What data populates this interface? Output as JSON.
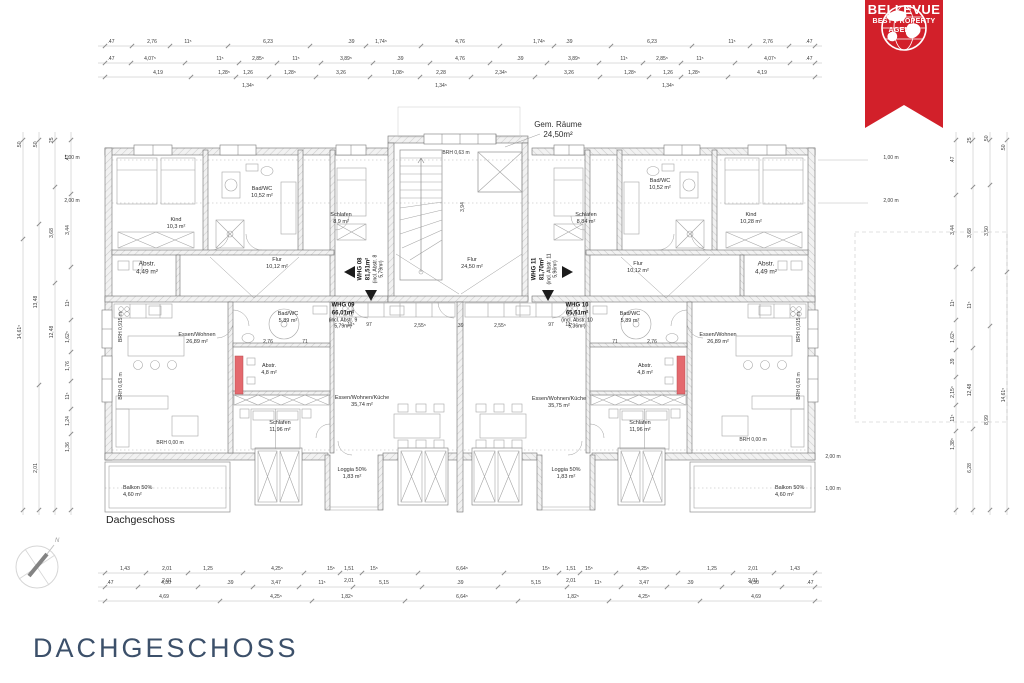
{
  "page_title": "DACHGESCHOSS",
  "plan_caption": "Dachgeschoss",
  "badge": {
    "brand": "BELLEVUE",
    "tagline_line1": "BEST PROPERTY",
    "tagline_line2": "AGENTS",
    "ribbon_color": "#d2202a"
  },
  "compass": {
    "north": "N"
  },
  "apartments": {
    "whg08": {
      "l1": "WHG 08",
      "l2": "81,51m²",
      "l3": "(incl. Abstr. 8",
      "l4": "5,79m²)"
    },
    "whg09": {
      "l1": "WHG 09",
      "l2": "66,01m²",
      "l3": "(incl. Abstr. 9",
      "l4": "5,79m²)"
    },
    "whg10": {
      "l1": "WHG 10",
      "l2": "65,61m²",
      "l3": "(incl. Abstr. 10",
      "l4": "5,36m²)"
    },
    "whg11": {
      "l1": "WHG 11",
      "l2": "81,70m²",
      "l3": "(incl. Abstr. 11",
      "l4": "5,96m²)"
    }
  },
  "rooms": {
    "gem": {
      "l1": "Gem. Räume",
      "l2": "24,50m²"
    },
    "flur_c": {
      "l1": "Flur",
      "l2": "24,50 m²"
    },
    "kind_l": {
      "l1": "Kind",
      "l2": "10,3 m²"
    },
    "bad_tl": {
      "l1": "Bad/WC",
      "l2": "10,52 m²"
    },
    "schlafen_tl": {
      "l1": "Schlafen",
      "l2": "8,9 m²"
    },
    "abstr_tl": {
      "l1": "Abstr.",
      "l2": "4,49 m²"
    },
    "flur_tl": {
      "l1": "Flur",
      "l2": "10,12 m²"
    },
    "kind_r": {
      "l1": "Kind",
      "l2": "10,28 m²"
    },
    "bad_tr": {
      "l1": "Bad/WC",
      "l2": "10,52 m²"
    },
    "schlafen_tr": {
      "l1": "Schlafen",
      "l2": "8,84 m²"
    },
    "abstr_tr": {
      "l1": "Abstr.",
      "l2": "4,49 m²"
    },
    "flur_tr": {
      "l1": "Flur",
      "l2": "10,12 m²"
    },
    "essen_l": {
      "l1": "Essen/Wohnen",
      "l2": "26,89 m²"
    },
    "badwc_9": {
      "l1": "Bad/WC",
      "l2": "5,89 m²"
    },
    "abstr_9": {
      "l1": "Abstr.",
      "l2": "4,8 m²"
    },
    "ewk_9": {
      "l1": "Essen/Wohnen/Küche",
      "l2": "35,74 m²"
    },
    "schlafen_9": {
      "l1": "Schlafen",
      "l2": "11,96 m²"
    },
    "loggia_9": {
      "l1": "Loggia 50%",
      "l2": "1,83 m²"
    },
    "balkon_l": {
      "l1": "Balkon 50%",
      "l2": "4,60 m²"
    },
    "essen_r": {
      "l1": "Essen/Wohnen",
      "l2": "26,89 m²"
    },
    "badwc_10": {
      "l1": "Bad/WC",
      "l2": "5,89 m²"
    },
    "abstr_10": {
      "l1": "Abstr.",
      "l2": "4,8 m²"
    },
    "ewk_10": {
      "l1": "Essen/Wohnen/Küche",
      "l2": "35,75 m²"
    },
    "schlafen_10": {
      "l1": "Schlafen",
      "l2": "11,96 m²"
    },
    "loggia_10": {
      "l1": "Loggia 50%",
      "l2": "1,83 m²"
    },
    "balkon_r": {
      "l1": "Balkon 50%",
      "l2": "4,60 m²"
    }
  },
  "annotations": {
    "brh_stair": "BRH 0,63 m",
    "dim394": "3,94",
    "brh000": "BRH 0,00 m",
    "brh0915": "BRH 0,915 m",
    "brh063": "BRH 0,63 m",
    "h100": "1,00 m",
    "h200": "2,00 m"
  },
  "dims": {
    "top1": [
      ".47",
      "2,76",
      "11⁵",
      "6,23",
      ".39",
      "1,74⁵",
      "4,76",
      "1,74⁵",
      ".39",
      "6,23",
      "11⁵",
      "2,76",
      ".47"
    ],
    "top2": [
      ".47",
      "4,07⁵",
      "11⁵",
      "2,85⁵",
      "11⁵",
      "3,89⁵",
      ".39",
      "4,76",
      ".39",
      "3,89⁵",
      "11⁵",
      "2,85⁵",
      "11⁵",
      "4,07⁵",
      ".47"
    ],
    "top3": [
      "4,19",
      "1,28⁵",
      "1,26",
      "1,28⁵",
      "3,26",
      "1,08⁵",
      "2,28",
      "2,34⁵",
      "3,26",
      "1,28⁵",
      "1,26",
      "1,28⁵",
      "4,19"
    ],
    "top3_sub": [
      "1,34⁵",
      "1,34⁵",
      "1,34⁵"
    ],
    "bottom1": [
      "1,43",
      "2,01",
      "1,25",
      "4,25⁵",
      "15⁵",
      "1,51",
      "15⁵",
      "6,64⁵",
      "15⁵",
      "1,51",
      "15⁵",
      "4,25⁵",
      "1,25",
      "2,01",
      "1,43"
    ],
    "bottom1_sub": [
      "2,01",
      "2,01",
      "2,01",
      "2,01"
    ],
    "bottom2": [
      ".47",
      "4,30",
      ".39",
      "3,47",
      "11⁵",
      "5,15",
      ".39",
      "5,15",
      "11⁵",
      "3,47",
      ".39",
      "4,30",
      ".47"
    ],
    "bottom3": [
      "4,69",
      "4,25⁵",
      "1,82⁵",
      "6,64⁵",
      "1,82⁵",
      "4,25⁵",
      "4,69"
    ],
    "left": [
      ".50",
      "14,61⁵",
      ".50",
      "13,48",
      "2,01",
      ".25",
      "3,68",
      "12,48",
      ".47",
      "3,44",
      "11⁵",
      "1,62⁵",
      "1,76",
      "11⁵",
      "1,24",
      "1,36"
    ],
    "right": [
      ".47",
      "3,44",
      "11⁵",
      "1,62⁵",
      ".39",
      "2,15⁵",
      "11⁵",
      "1,38⁵",
      ".25",
      "3,68",
      "11⁵",
      "12,48",
      "6,28",
      ".50",
      "3,50",
      "8,99",
      ".50",
      "14,61⁵"
    ],
    "interior": [
      "11⁵",
      "97",
      "2,55⁵",
      ".39",
      "2,55⁵",
      "97",
      "11⁵",
      "2,76",
      "71",
      "71",
      "2,76"
    ]
  },
  "colors": {
    "accent_red": "#d2202a",
    "highlight_red": "#e4696e",
    "title_color": "#3c506a"
  }
}
